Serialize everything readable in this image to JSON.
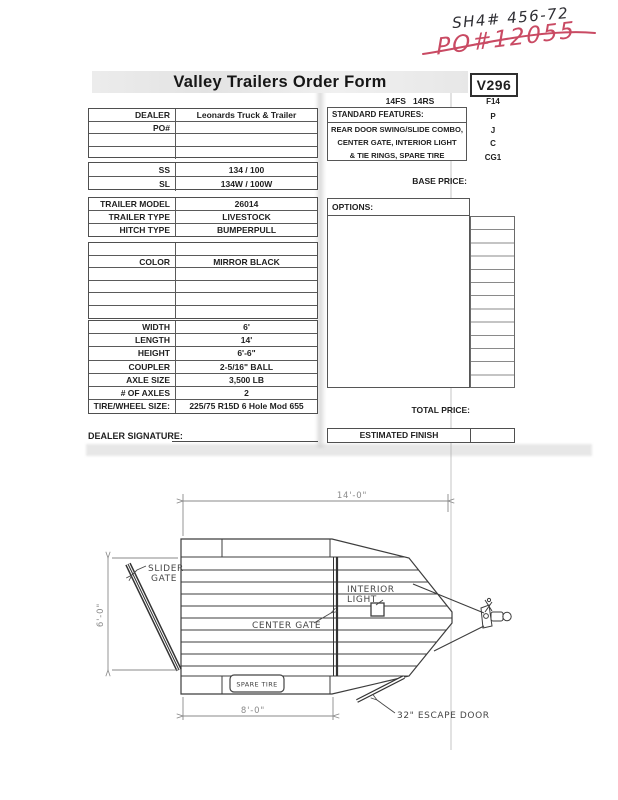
{
  "handwriting": {
    "stock_no": "SH4# 456-72",
    "po_no": "PO#12055"
  },
  "header": {
    "title": "Valley Trailers Order Form",
    "form_code": "V296",
    "model_line": "14FS   14RS",
    "model_code": "F14"
  },
  "codes": [
    "P",
    "J",
    "C",
    "CG1"
  ],
  "left_table": {
    "group1": {
      "rows": [
        {
          "label": "DEALER",
          "value": "Leonards Truck & Trailer"
        },
        {
          "label": "PO#",
          "value": ""
        },
        {
          "label": "",
          "value": ""
        },
        {
          "label": "",
          "value": ""
        }
      ]
    },
    "group2": {
      "rows": [
        {
          "label": "SS",
          "value": "134  /  100"
        },
        {
          "label": "SL",
          "value": "134W  /  100W"
        }
      ]
    },
    "group3": {
      "rows": [
        {
          "label": "TRAILER MODEL",
          "value": "26014"
        },
        {
          "label": "TRAILER TYPE",
          "value": "LIVESTOCK"
        },
        {
          "label": "HITCH TYPE",
          "value": "BUMPERPULL"
        }
      ]
    },
    "group4": {
      "rows": [
        {
          "label": "",
          "value": ""
        },
        {
          "label": "COLOR",
          "value": "MIRROR BLACK"
        },
        {
          "label": "",
          "value": ""
        },
        {
          "label": "",
          "value": ""
        },
        {
          "label": "",
          "value": ""
        },
        {
          "label": "",
          "value": ""
        }
      ]
    },
    "group5": {
      "rows": [
        {
          "label": "WIDTH",
          "value": "6'"
        },
        {
          "label": "LENGTH",
          "value": "14'"
        },
        {
          "label": "HEIGHT",
          "value": "6'-6\""
        },
        {
          "label": "COUPLER",
          "value": "2-5/16\" BALL"
        },
        {
          "label": "AXLE SIZE",
          "value": "3,500 LB"
        },
        {
          "label": "# OF AXLES",
          "value": "2"
        },
        {
          "label": "TIRE/WHEEL SIZE:",
          "value": "225/75 R15D 6 Hole Mod 655"
        }
      ]
    }
  },
  "right_panel": {
    "standard_features_title": "STANDARD FEATURES:",
    "standard_features_lines": [
      "REAR DOOR SWING/SLIDE COMBO,",
      "CENTER GATE, INTERIOR LIGHT",
      "& TIE RINGS, SPARE TIRE"
    ],
    "base_price_label": "BASE PRICE:",
    "options_label": "OPTIONS:",
    "total_price_label": "TOTAL PRICE:",
    "estimated_finish_label": "ESTIMATED FINISH"
  },
  "signature_label": "DEALER SIGNATURE:",
  "diagram": {
    "dim_length": "14'-0\"",
    "dim_height": "6'-0\"",
    "dim_rear": "8'-0\"",
    "slider_gate_1": "SLIDER",
    "slider_gate_2": "GATE",
    "center_gate": "CENTER GATE",
    "interior_light_1": "INTERIOR",
    "interior_light_2": "LIGHT",
    "spare_tire": "SPARE TIRE",
    "escape_door": "32\" ESCAPE DOOR"
  },
  "colors": {
    "ink_red": "#c94a63",
    "ink_black": "#2e2e33",
    "form_line": "#4f4f4f",
    "title_band": "#e8e8e8"
  }
}
